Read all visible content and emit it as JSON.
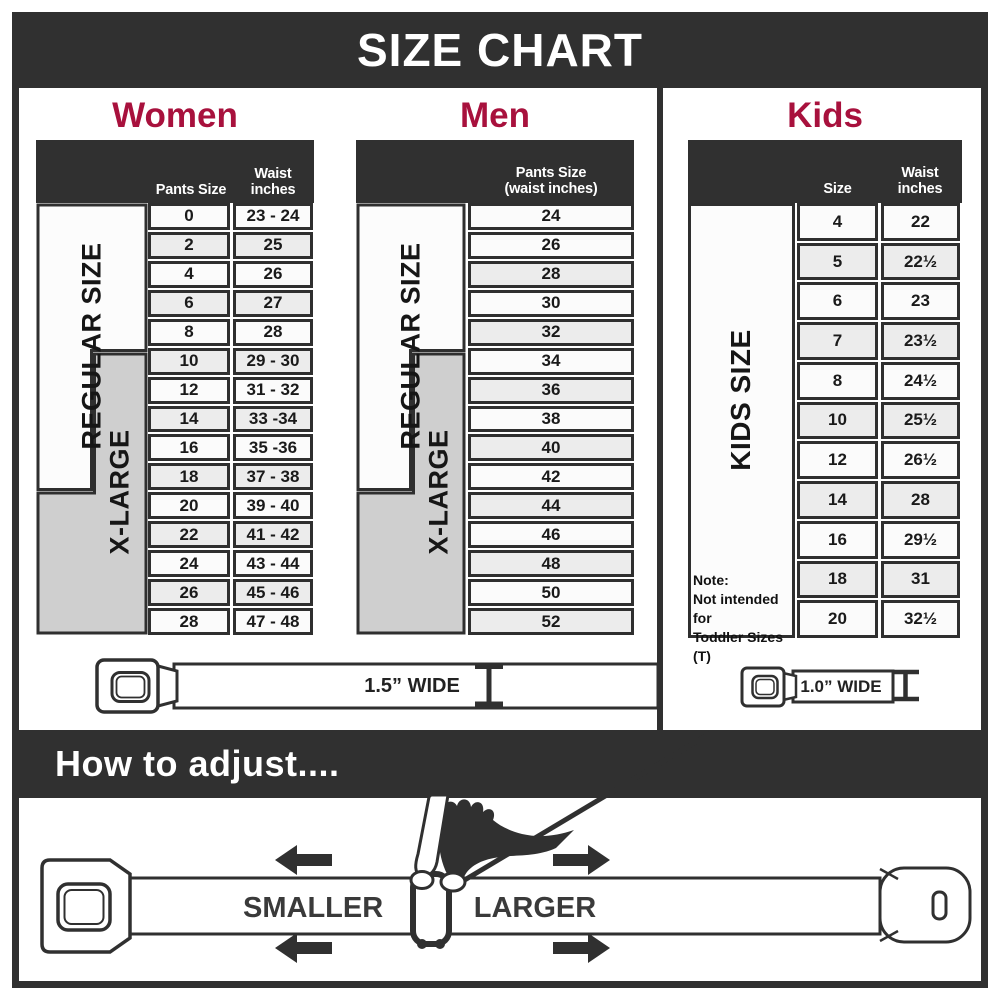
{
  "banner": {
    "title": "SIZE CHART"
  },
  "sections": {
    "women": {
      "heading": "Women",
      "col1_header": "Pants Size",
      "col2_header_line1": "Waist",
      "col2_header_line2": "inches",
      "regular_label": "REGULAR SIZE",
      "xlarge_label": "X-LARGE",
      "rows": [
        {
          "size": "0",
          "waist": "23 - 24"
        },
        {
          "size": "2",
          "waist": "25"
        },
        {
          "size": "4",
          "waist": "26"
        },
        {
          "size": "6",
          "waist": "27"
        },
        {
          "size": "8",
          "waist": "28"
        },
        {
          "size": "10",
          "waist": "29 - 30"
        },
        {
          "size": "12",
          "waist": "31 - 32"
        },
        {
          "size": "14",
          "waist": "33 -34"
        },
        {
          "size": "16",
          "waist": "35 -36"
        },
        {
          "size": "18",
          "waist": "37 - 38"
        },
        {
          "size": "20",
          "waist": "39 - 40"
        },
        {
          "size": "22",
          "waist": "41 - 42"
        },
        {
          "size": "24",
          "waist": "43 - 44"
        },
        {
          "size": "26",
          "waist": "45 - 46"
        },
        {
          "size": "28",
          "waist": "47 - 48"
        }
      ]
    },
    "men": {
      "heading": "Men",
      "col_header_line1": "Pants Size",
      "col_header_line2": "(waist inches)",
      "regular_label": "REGULAR SIZE",
      "xlarge_label": "X-LARGE",
      "rows": [
        "24",
        "26",
        "28",
        "30",
        "32",
        "34",
        "36",
        "38",
        "40",
        "42",
        "44",
        "46",
        "48",
        "50",
        "52"
      ]
    },
    "kids": {
      "heading": "Kids",
      "col1_header": "Size",
      "col2_header_line1": "Waist",
      "col2_header_line2": "inches",
      "label": "KIDS SIZE",
      "note_line1": "Note:",
      "note_line2": "Not intended for",
      "note_line3": "Toddler Sizes (T)",
      "rows": [
        {
          "size": "4",
          "waist": "22"
        },
        {
          "size": "5",
          "waist": "22½"
        },
        {
          "size": "6",
          "waist": "23"
        },
        {
          "size": "7",
          "waist": "23½"
        },
        {
          "size": "8",
          "waist": "24½"
        },
        {
          "size": "10",
          "waist": "25½"
        },
        {
          "size": "12",
          "waist": "26½"
        },
        {
          "size": "14",
          "waist": "28"
        },
        {
          "size": "16",
          "waist": "29½"
        },
        {
          "size": "18",
          "waist": "31"
        },
        {
          "size": "20",
          "waist": "32½"
        }
      ]
    }
  },
  "belts": {
    "adult_width_label": "1.5” WIDE",
    "kids_width_label": "1.0” WIDE"
  },
  "adjust": {
    "title": "How to adjust....",
    "smaller_label": "SMALLER",
    "larger_label": "LARGER"
  },
  "colors": {
    "accent": "#A8113D",
    "dark": "#303030",
    "row_light": "#fbfbfb",
    "row_shaded": "#ececec",
    "label_gray": "#cfcfcf"
  }
}
